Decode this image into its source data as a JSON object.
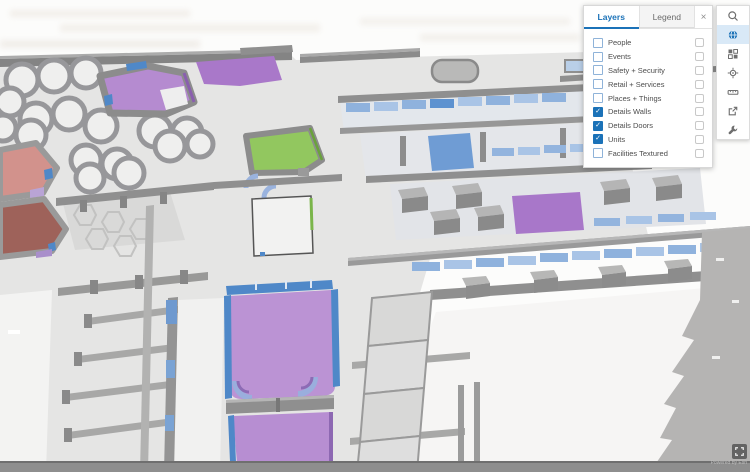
{
  "panel": {
    "tabs": [
      {
        "label": "Layers",
        "active": true
      },
      {
        "label": "Legend",
        "active": false
      }
    ],
    "close_label": "×",
    "layers": [
      {
        "label": "People",
        "checked": false
      },
      {
        "label": "Events",
        "checked": false
      },
      {
        "label": "Safety + Security",
        "checked": false
      },
      {
        "label": "Retail + Services",
        "checked": false
      },
      {
        "label": "Places + Things",
        "checked": false
      },
      {
        "label": "Details Walls",
        "checked": true
      },
      {
        "label": "Details Doors",
        "checked": true
      },
      {
        "label": "Units",
        "checked": true
      },
      {
        "label": "Facilities Textured",
        "checked": false
      }
    ]
  },
  "toolbar": {
    "buttons": [
      {
        "icon": "search"
      },
      {
        "icon": "basemap-globe",
        "active": true
      },
      {
        "icon": "basemap-gallery"
      },
      {
        "icon": "locate"
      },
      {
        "icon": "measure"
      },
      {
        "icon": "share"
      },
      {
        "icon": "tools"
      }
    ]
  },
  "map": {
    "attribution": "Powered by Esri",
    "view": "3D isometric indoor floor plan"
  },
  "colors": {
    "accent_blue": "#1b72b8",
    "active_tool_bg": "#d9e9f7",
    "unit_purple": "#bb93d4",
    "unit_green": "#92c75f",
    "unit_salmon": "#d2928c",
    "unit_dark_red": "#9e625a",
    "door_blue": "#4f88c8",
    "wall_gray": "#8f8f8f",
    "floor_gray": "#e5e5e4"
  }
}
